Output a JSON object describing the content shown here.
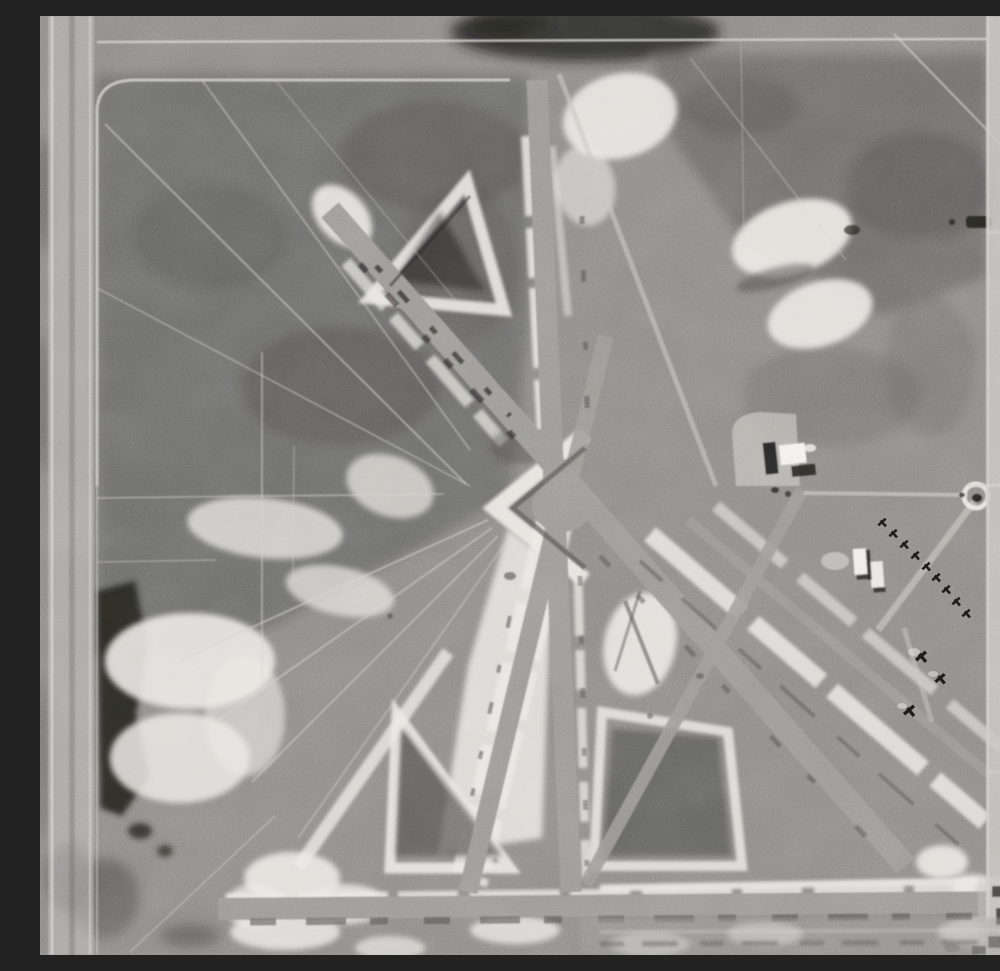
{
  "scene": {
    "title": "Black-and-white vertical aerial photograph of a desert airfield",
    "description": "Monochrome nadir aerial photo: a WWII-style airfield with three runways crossing at a central intersection forming triangular infields, white disturbed-soil shoulders, an east-west runway along the bottom, a hangar with dark shadow, a diagonal row of parked aircraft on the east apron, a circular tank, a small town street grid with houses and trees along the right edge, and desert scrub crossed by dirt trails on the west half.",
    "monochrome": true
  },
  "palette": {
    "base": "#8e8c89",
    "scrub": "#6e6d6a",
    "scrub-dark": "#555451",
    "shadow": "#232220",
    "runway": "#9b9995",
    "disturbed": "#eae8e3",
    "trail": "#d4d2cd",
    "road": "#c6c4bf",
    "structure": "#f3f1ed",
    "town-dark": "#343330"
  },
  "features": {
    "runway_ns": "north-south runway",
    "runway_nwse": "northwest-southeast runway",
    "runway_nesw": "northeast-southwest runway",
    "runway_ew": "east-west runway",
    "intersection": "central runway intersection",
    "infield_triangles": "triangular taxiway infields",
    "hangar": "hangar with shadow",
    "aircraft_row": "row of parked aircraft",
    "tank": "circular tank",
    "town": "town street grid with houses",
    "desert": "desert scrub with dirt trails",
    "boundary_road": "western boundary road"
  }
}
